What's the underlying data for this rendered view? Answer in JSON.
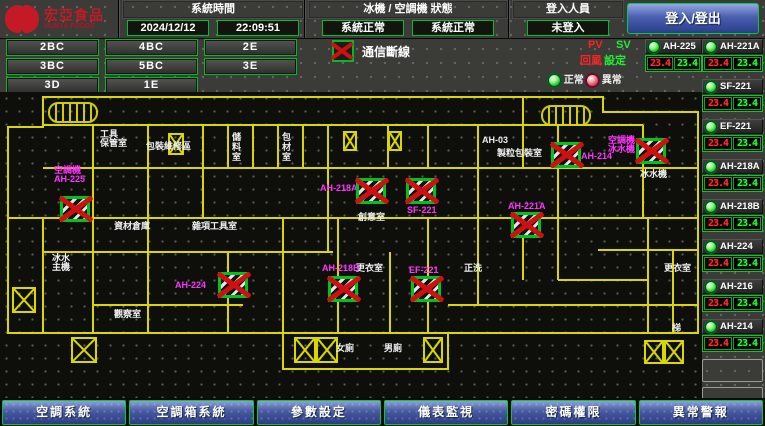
{
  "header": {
    "logo_title": "宏亞食品",
    "logo_subtitle": "HUNYA FOODS",
    "time_label": "系統時間",
    "date": "2024/12/12",
    "time": "22:09:51",
    "status_label": "冰機 / 空調機 狀態",
    "chiller_status": "系統正常",
    "ahu_status": "系統正常",
    "login_label": "登入人員",
    "login_status": "未登入",
    "login_button": "登入/登出"
  },
  "floors": [
    "2BC",
    "4BC",
    "2E",
    "3BC",
    "5BC",
    "3E",
    "3D",
    "1E"
  ],
  "legend": {
    "comm_loss": "通信斷線",
    "pv": "PV",
    "pv_sub": "回風",
    "sv": "SV",
    "sv_sub": "設定",
    "normal": "正常",
    "abnormal": "異常"
  },
  "units": [
    {
      "name": "AH-225",
      "pv": "23.4",
      "sv": "23.4"
    },
    {
      "name": "AH-221A",
      "pv": "23.4",
      "sv": "23.4"
    },
    {
      "name": "SF-221",
      "pv": "23.4",
      "sv": "23.4"
    },
    {
      "name": "EF-221",
      "pv": "23.4",
      "sv": "23.4"
    },
    {
      "name": "AH-218A",
      "pv": "23.4",
      "sv": "23.4"
    },
    {
      "name": "AH-218B",
      "pv": "23.4",
      "sv": "23.4"
    },
    {
      "name": "AH-224",
      "pv": "23.4",
      "sv": "23.4"
    },
    {
      "name": "AH-216",
      "pv": "23.4",
      "sv": "23.4"
    },
    {
      "name": "AH-214",
      "pv": "23.4",
      "sv": "23.4"
    }
  ],
  "empty_slots": 2,
  "map": {
    "devices": [
      {
        "id": "AH-225",
        "label": "空調機\nAH-225",
        "label_x": 54,
        "label_y": 74,
        "x": 60,
        "y": 104
      },
      {
        "id": "AH-218A",
        "label": "AH-218A",
        "label_x": 320,
        "label_y": 92,
        "x": 356,
        "y": 86
      },
      {
        "id": "SF-221",
        "label": "SF-221",
        "label_x": 407,
        "label_y": 114,
        "x": 406,
        "y": 86
      },
      {
        "id": "AH-214",
        "label": "AH-214",
        "label_x": 581,
        "label_y": 60,
        "x": 551,
        "y": 50
      },
      {
        "id": "冰水機",
        "label": "空調機\n冰水機",
        "label_x": 608,
        "label_y": 44,
        "x": 636,
        "y": 46
      },
      {
        "id": "AH-221A",
        "label": "AH-221A",
        "label_x": 508,
        "label_y": 110,
        "x": 511,
        "y": 120
      },
      {
        "id": "AH-224",
        "label": "AH-224",
        "label_x": 175,
        "label_y": 189,
        "x": 218,
        "y": 180
      },
      {
        "id": "AH-218B",
        "label": "AH-218B",
        "label_x": 322,
        "label_y": 172,
        "x": 328,
        "y": 184
      },
      {
        "id": "EF-221",
        "label": "EF-221",
        "label_x": 409,
        "label_y": 174,
        "x": 411,
        "y": 184
      }
    ],
    "rooms": [
      {
        "text": "工具\n保管室",
        "x": 100,
        "y": 38
      },
      {
        "text": "包裝維修區",
        "x": 146,
        "y": 50
      },
      {
        "text": "儲料室",
        "x": 231,
        "y": 40,
        "vertical": true
      },
      {
        "text": "包材室",
        "x": 281,
        "y": 40,
        "vertical": true
      },
      {
        "text": "AH-03",
        "x": 482,
        "y": 44
      },
      {
        "text": "製粒包裝室",
        "x": 497,
        "y": 57
      },
      {
        "text": "冰水機",
        "x": 640,
        "y": 78
      },
      {
        "text": "創意室",
        "x": 358,
        "y": 121
      },
      {
        "text": "資材倉庫",
        "x": 114,
        "y": 130
      },
      {
        "text": "雜項工具室",
        "x": 192,
        "y": 130
      },
      {
        "text": "冰水\n主機",
        "x": 52,
        "y": 162
      },
      {
        "text": "更衣室",
        "x": 356,
        "y": 172
      },
      {
        "text": "正洗",
        "x": 464,
        "y": 172
      },
      {
        "text": "更衣室",
        "x": 664,
        "y": 172
      },
      {
        "text": "觀察室",
        "x": 114,
        "y": 218
      },
      {
        "text": "梯",
        "x": 672,
        "y": 232
      },
      {
        "text": "女廁",
        "x": 336,
        "y": 252
      },
      {
        "text": "男廁",
        "x": 384,
        "y": 252
      }
    ],
    "marks": [
      {
        "x": 168,
        "y": 41,
        "w": 16,
        "h": 22
      },
      {
        "x": 343,
        "y": 39,
        "w": 14,
        "h": 20
      },
      {
        "x": 388,
        "y": 39,
        "w": 14,
        "h": 20
      },
      {
        "x": 12,
        "y": 195,
        "w": 24,
        "h": 26
      },
      {
        "x": 71,
        "y": 245,
        "w": 26,
        "h": 26
      },
      {
        "x": 294,
        "y": 245,
        "w": 22,
        "h": 26
      },
      {
        "x": 316,
        "y": 245,
        "w": 22,
        "h": 26
      },
      {
        "x": 423,
        "y": 245,
        "w": 20,
        "h": 26
      },
      {
        "x": 644,
        "y": 248,
        "w": 20,
        "h": 24
      },
      {
        "x": 664,
        "y": 248,
        "w": 20,
        "h": 24
      }
    ],
    "stairs": [
      {
        "x": 48,
        "y": 10
      },
      {
        "x": 541,
        "y": 13
      }
    ]
  },
  "nav": [
    "空調系統",
    "空調箱系統",
    "參數設定",
    "儀表監視",
    "密碼權限",
    "異常警報"
  ],
  "colors": {
    "accent_green": "#00cc22",
    "alarm_red": "#cf1010",
    "magenta": "#ff35ff",
    "wall_yellow": "#d8d800",
    "pv_red": "#ff3030",
    "sv_green": "#2aff3a",
    "nav_blue": "#46589f"
  }
}
